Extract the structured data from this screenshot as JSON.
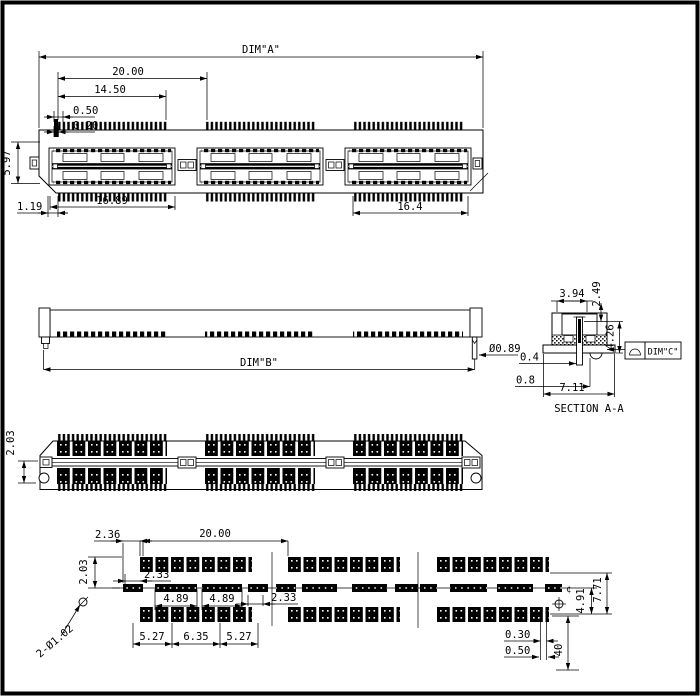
{
  "drawing": {
    "views": {
      "top": {
        "dim_a": "DIM\"A\"",
        "pitch_total": "20.00",
        "d_1450": "14.50",
        "pin_pitch": "0.50",
        "pin_width": "0.20",
        "body_height": "5.97",
        "d_119": "1.19",
        "bay_width": "16.89",
        "d_164": "16.4"
      },
      "side": {
        "dim_b": "DIM\"B\"",
        "peg_dia": "Ø0.89",
        "d_04": "0.4",
        "d_08": "0.8"
      },
      "section": {
        "label": "SECTION A-A",
        "d_394": "3.94",
        "d_249": "2.49",
        "d_426": "4.26",
        "d_711": "7.11",
        "dim_c": "DIM\"C\""
      },
      "rear": {
        "d_203": "2.03"
      },
      "footprint": {
        "d_236": "2.36",
        "d_2000": "20.00",
        "d_203": "2.03",
        "d_233_left": "2.33",
        "d_489_a": "4.89",
        "d_489_b": "4.89",
        "d_233_right": "2.33",
        "holes": "2-Ø1.02",
        "d_527_a": "5.27",
        "d_635": "6.35",
        "d_527_b": "5.27",
        "d_030": "0.30",
        "d_050": "0.50",
        "d_40": "40",
        "d_491": "4.91",
        "d_771": "7.71",
        "center_mark": "¢"
      }
    }
  }
}
